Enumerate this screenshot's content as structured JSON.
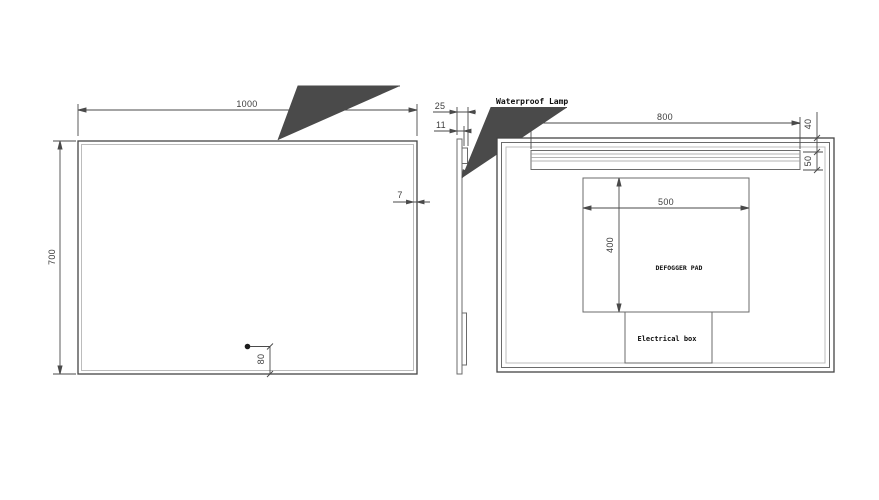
{
  "colors": {
    "background": "#ffffff",
    "line": "#454545",
    "dimension_text": "#3d3d3d",
    "label_text": "#0d0d0d"
  },
  "labels": {
    "waterproof_lamp": "Waterproof Lamp"
  },
  "views": {
    "front": {
      "width_dim": "1000",
      "height_dim": "700",
      "edge_dim": "7",
      "sensor_height_dim": "80"
    },
    "side": {
      "depth_dim": "25",
      "panel_dim": "11"
    },
    "back": {
      "lamp_length_dim": "800",
      "lamp_offset_dim": "40",
      "lamp_height_dim": "50",
      "pad_width_dim": "500",
      "pad_height_dim": "400",
      "pad_label": "DEFOGGER PAD",
      "electrical_box_label": "Electrical box"
    }
  }
}
